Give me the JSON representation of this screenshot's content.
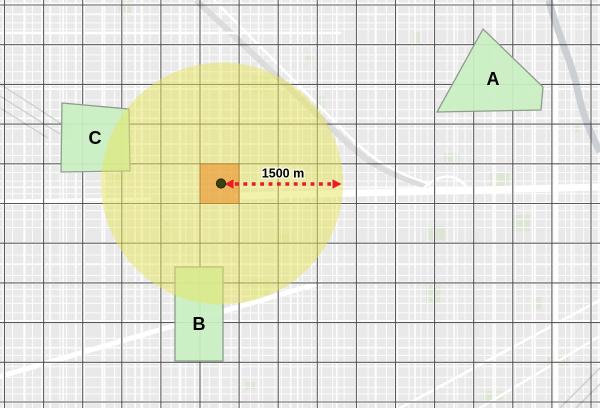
{
  "map": {
    "width": 600,
    "height": 408,
    "colors": {
      "base": "#e9e9e9",
      "street": "#ffffff",
      "park": "#dbe6d3",
      "river": "#c9ced3",
      "rail": "#dcdcdc",
      "rail_hatch": "#d2d2d2",
      "graticule": "#4b4b4b",
      "buffer_fill": "#e7e55b",
      "zone_fill": "#c9efc2",
      "zone_stroke": "#8f9c8f",
      "impact_fill": "#eb7d10",
      "impact_stroke": "#b4651a",
      "arrow": "#e91c2c",
      "point_fill": "#3a430f",
      "point_stroke": "#252c08",
      "label": "#000000"
    },
    "graticule": {
      "x0": 4.5,
      "dx": 39.1,
      "nx": 16,
      "y0": 5,
      "dy": 39.7,
      "ny": 11
    },
    "basemap": {
      "seed": 20,
      "major_roads": [
        {
          "d": "M 238 196 L 600 187",
          "w": 7
        },
        {
          "d": "M 556 0 L 556 408",
          "w": 4.5
        },
        {
          "d": "M 0 33 L 340 33",
          "w": 2.6
        },
        {
          "d": "M 0 201 L 150 199",
          "w": 3.2
        },
        {
          "d": "M -5 378 L 320 283",
          "w": 5
        },
        {
          "d": "M 400 408 L 600 300",
          "w": 2.6
        },
        {
          "d": "M 480 408 L 600 336",
          "w": 2.4
        },
        {
          "d": "M 420 192 C 438 172 456 172 468 189",
          "w": 2.6
        },
        {
          "d": "M 214 0 L 345 132 C 370 158 392 172 430 184",
          "w": 2.4
        }
      ],
      "rail_band": {
        "d": "M 196 0 L 342 138 C 368 164 392 176 428 186",
        "w": 6
      },
      "rail_hatch": [
        {
          "d": "M 0 84 L 74 132",
          "w": 1.4
        },
        {
          "d": "M 0 96 L 60 134",
          "w": 1.4
        },
        {
          "d": "M 0 108 L 48 138",
          "w": 1.4
        },
        {
          "d": "M 560 408 L 600 368",
          "w": 1.6
        },
        {
          "d": "M 576 408 L 600 384",
          "w": 1.6
        }
      ],
      "river": {
        "d": "M 549 0 C 557 34 572 62 577 88 C 583 116 590 132 600 152",
        "w": 7
      }
    },
    "buffer_circle": {
      "cx": 222,
      "cy": 183.5,
      "r": 121
    },
    "impact_cell": {
      "x": 200,
      "y": 163.8,
      "w": 39.1,
      "h": 39.7
    },
    "center_point": {
      "cx": 221,
      "cy": 183.5,
      "r": 4.6
    },
    "annotation": {
      "distance_label": "1500 m",
      "y": 184,
      "tip_left": 224.5,
      "tip_right": 341.5,
      "head_len": 9,
      "head_half": 4.8,
      "dash": "3.8 4.6",
      "dash_width": 3.5,
      "label_x": 283,
      "label_y": 177.5
    },
    "zones": [
      {
        "label": "A",
        "points": [
          [
            483,
            29
          ],
          [
            543,
            87
          ],
          [
            541,
            110
          ],
          [
            437,
            112
          ]
        ],
        "label_x": 493,
        "label_y": 85
      },
      {
        "label": "B",
        "points": [
          [
            175,
            267
          ],
          [
            223,
            267
          ],
          [
            223,
            361
          ],
          [
            175,
            361
          ]
        ],
        "label_x": 199,
        "label_y": 330
      },
      {
        "label": "C",
        "points": [
          [
            62,
            103
          ],
          [
            129,
            109
          ],
          [
            130,
            171
          ],
          [
            61,
            172
          ]
        ],
        "label_x": 95,
        "label_y": 144
      }
    ]
  }
}
